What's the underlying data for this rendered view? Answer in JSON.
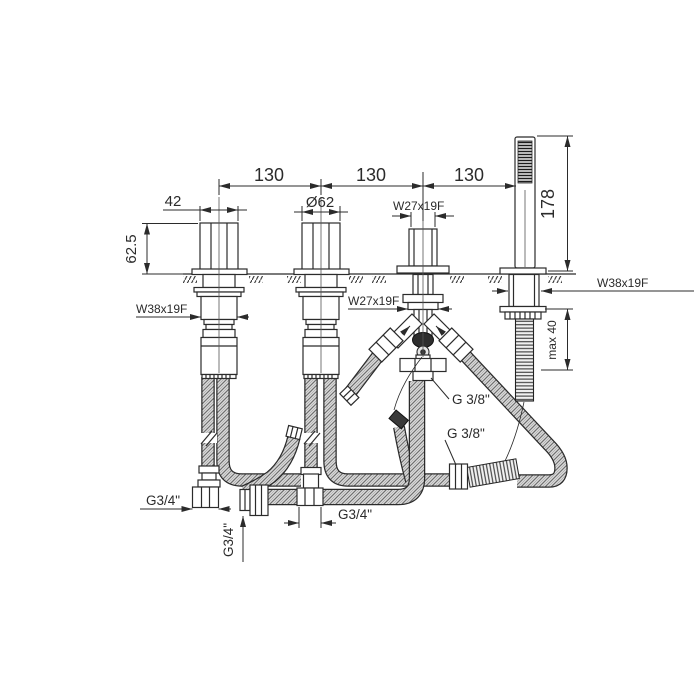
{
  "colors": {
    "line": "#2b2b2b",
    "background": "#ffffff"
  },
  "labels": {
    "span1": "130",
    "span2": "130",
    "span3": "130",
    "handle_width": "42",
    "trim_diameter": "Ø62",
    "diverter_thread_top": "W27x19F",
    "handshower_height": "178",
    "handle_height": "62.5",
    "valve_thread_left": "W38x19F",
    "diverter_thread_bottom": "W27x19F",
    "handshower_thread": "W38x19F",
    "max_deck_thickness": "max 40",
    "outlet_thread_upper": "G 3/8\"",
    "outlet_thread_lower": "G 3/8\"",
    "supply_thread_left": "G3/4\"",
    "tee_thread_bottom": "G3/4\"",
    "supply_thread_vertical": "G3/4\""
  }
}
